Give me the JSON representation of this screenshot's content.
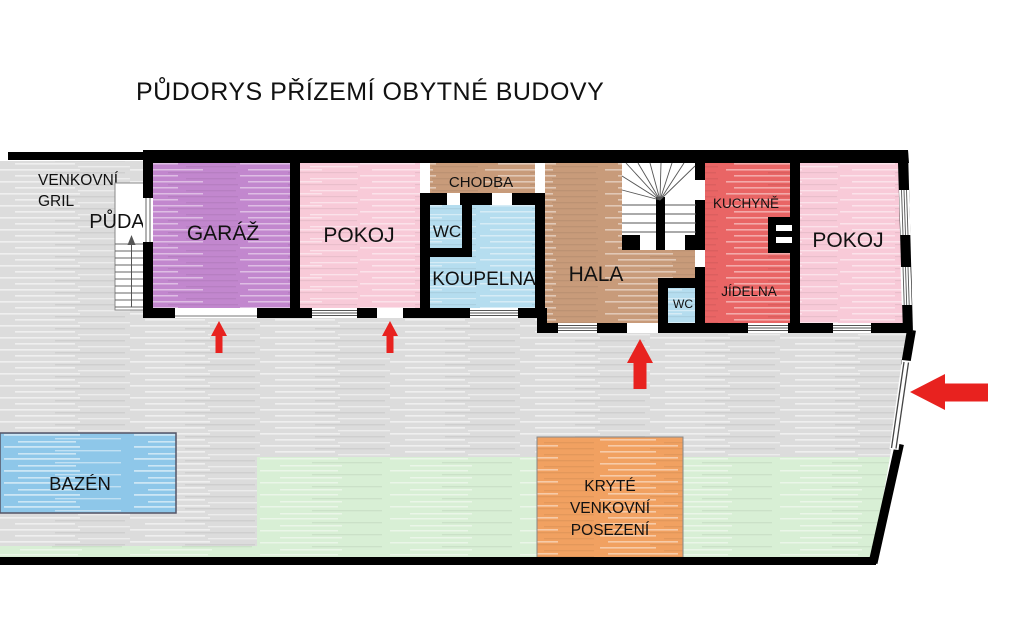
{
  "title": "PŮDORYS PŘÍZEMÍ OBYTNÉ BUDOVY",
  "colors": {
    "wall": "#000000",
    "paving": "#dcdcdc",
    "lawn": "#d8efd5",
    "pool": "#8ec7e9",
    "garage": "#c287ce",
    "bedroom": "#f8cad8",
    "corridor": "#c89b7a",
    "bath": "#b5ddef",
    "kitchen": "#e96565",
    "seating": "#f1a161",
    "arrow": "#e8221f"
  },
  "rooms": {
    "outdoor_grill": {
      "line1": "VENKOVNÍ",
      "line2": "GRIL"
    },
    "attic": {
      "label": "PŮDA"
    },
    "garage": {
      "label": "GARÁŽ"
    },
    "bedroom_left": {
      "label": "POKOJ"
    },
    "corridor": {
      "label": "CHODBA"
    },
    "wc": {
      "label": "WC"
    },
    "bathroom": {
      "label": "KOUPELNA"
    },
    "hall": {
      "label": "HALA"
    },
    "kitchen": {
      "label": "KUCHYNĚ"
    },
    "dining": {
      "label": "JÍDELNA"
    },
    "wc_hall": {
      "label": "WC"
    },
    "bedroom_right": {
      "label": "POKOJ"
    },
    "pool": {
      "label": "BAZÉN"
    },
    "seating": {
      "line1": "KRYTÉ",
      "line2": "VENKOVNÍ",
      "line3": "POSEZENÍ"
    }
  }
}
